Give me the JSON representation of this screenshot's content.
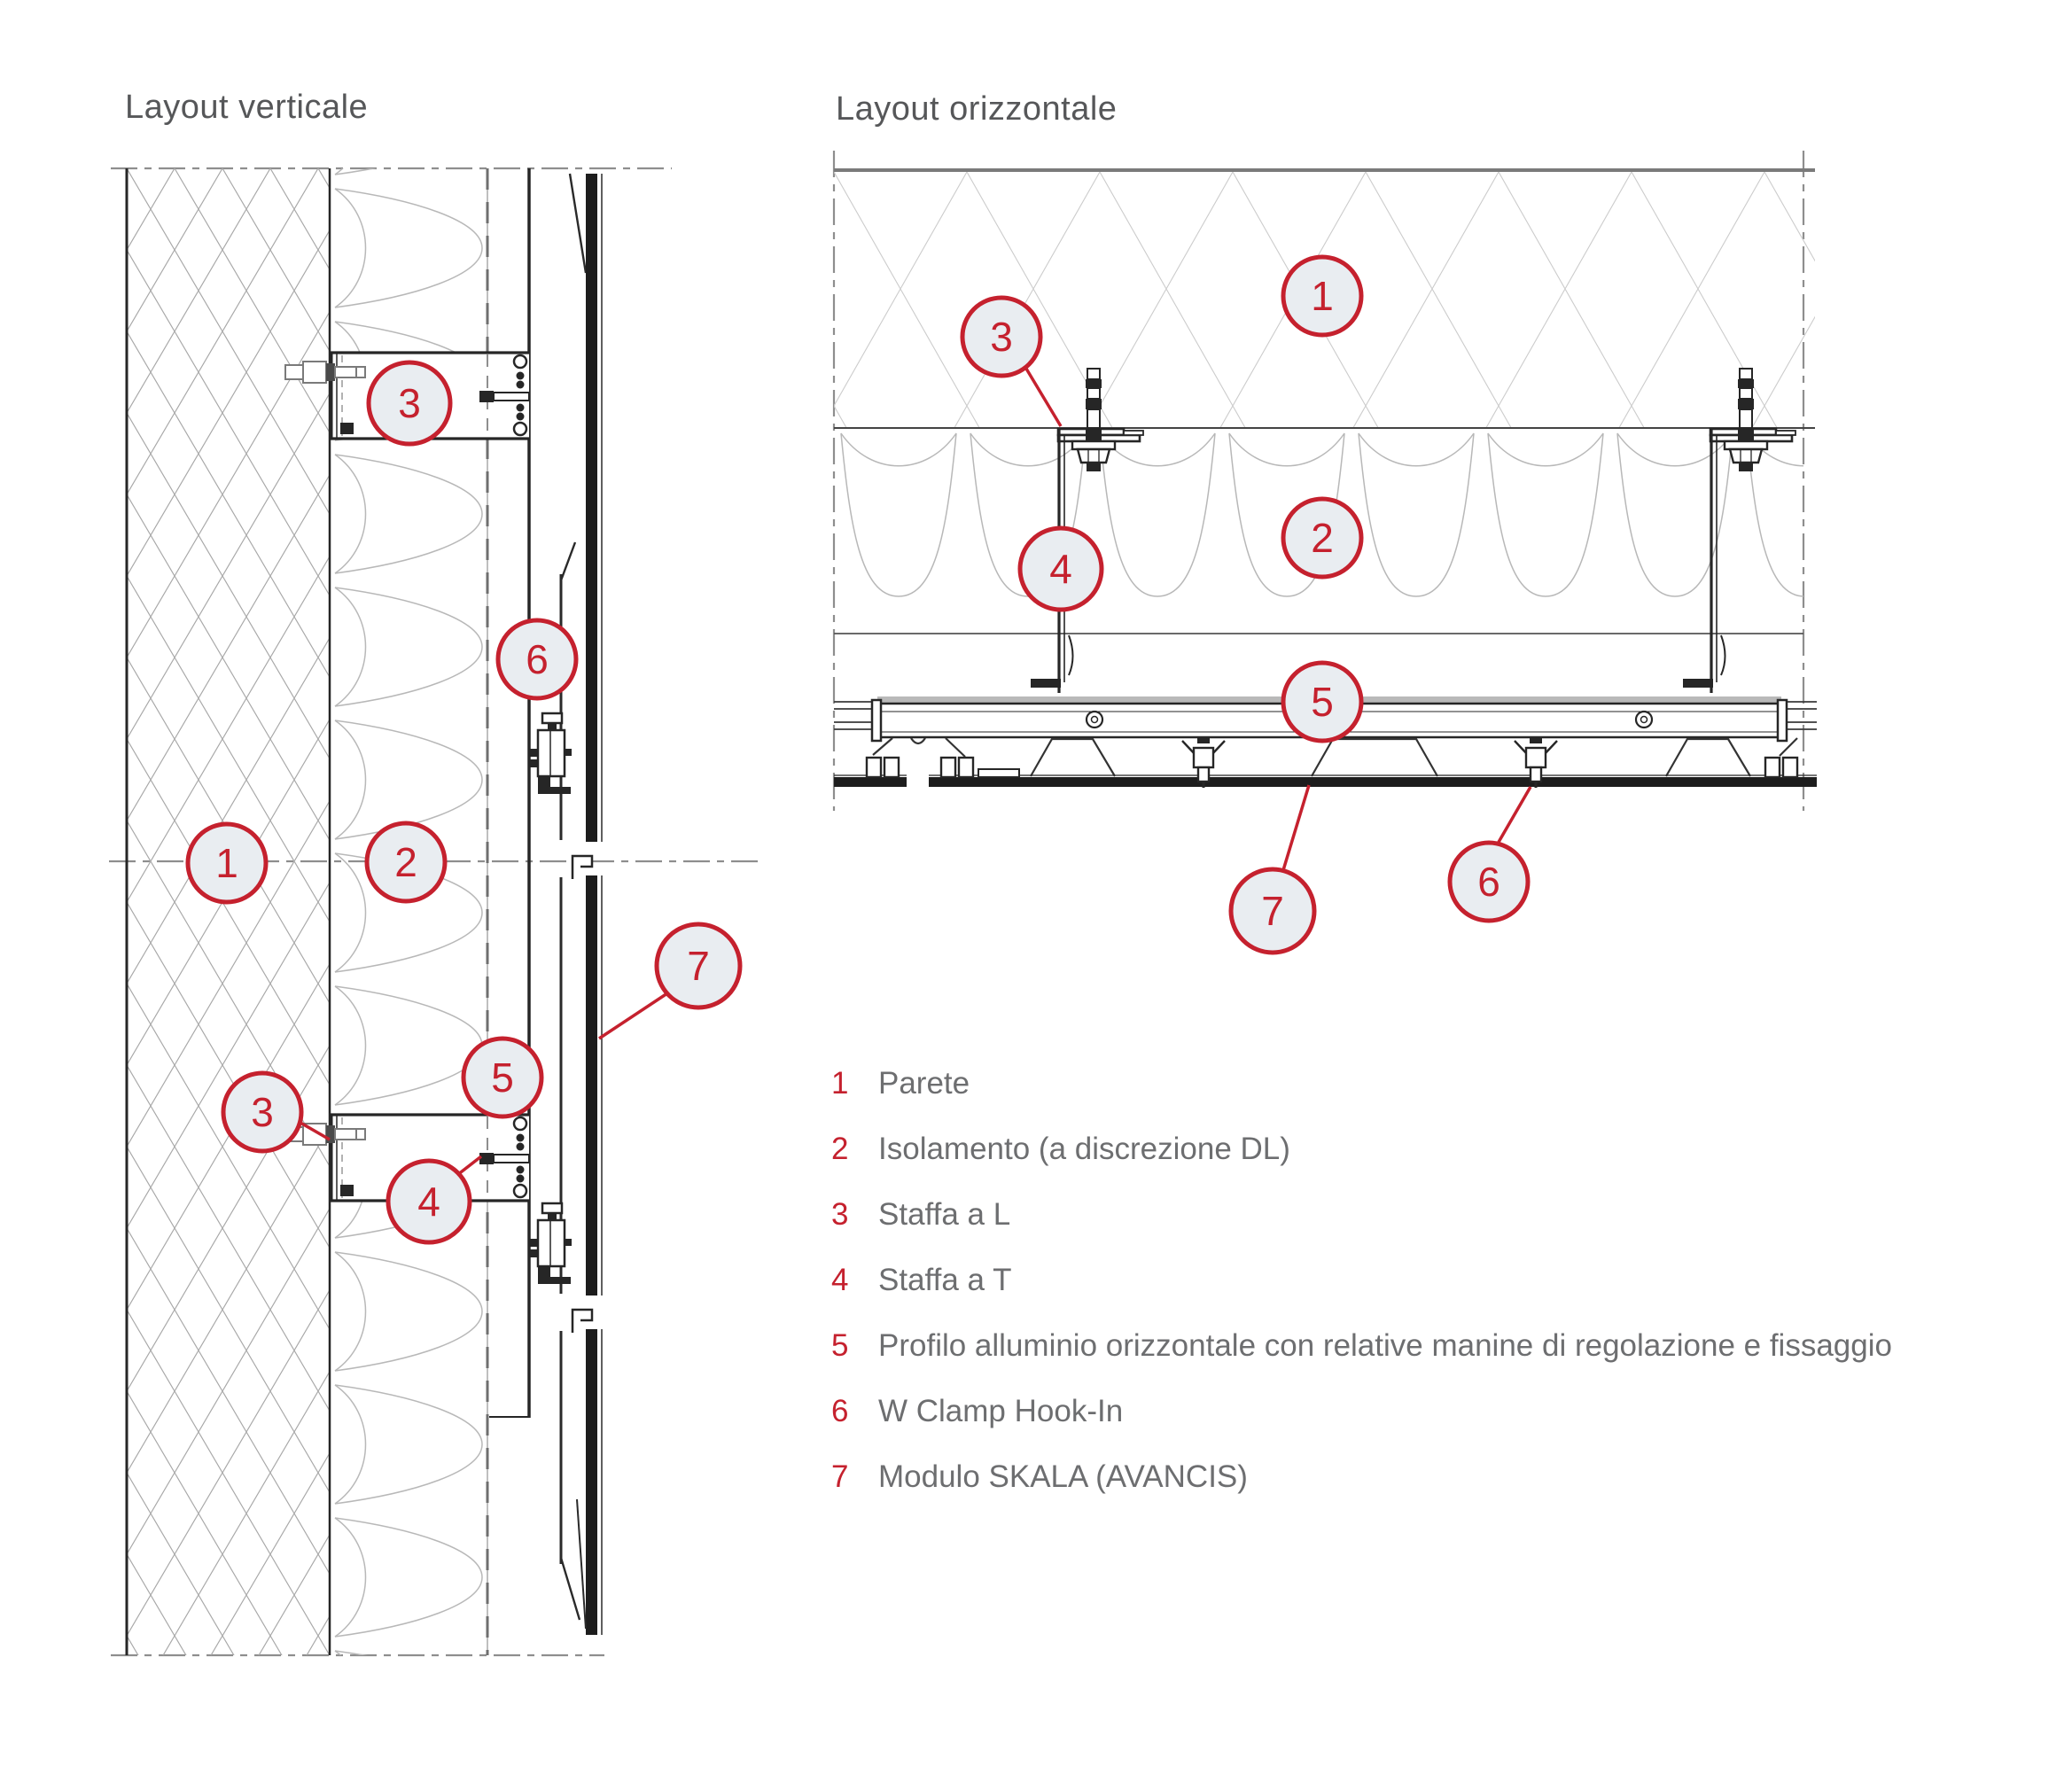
{
  "page": {
    "background": "#ffffff"
  },
  "colors": {
    "accent_red": "#c5212e",
    "callout_fill": "#e9edf1",
    "title_gray": "#565759",
    "legend_text_gray": "#6d6e70",
    "line_dark": "#262626",
    "hatch_gray": "#a8a8a8",
    "hatch_light_gray": "#cccccc",
    "insulation_gray": "#b8b8b8",
    "dashdot_gray": "#8e8e8e"
  },
  "diagrams": {
    "verticale": {
      "title": "Layout verticale",
      "callouts": [
        {
          "label": "3"
        },
        {
          "label": "6"
        },
        {
          "label": "1"
        },
        {
          "label": "2"
        },
        {
          "label": "7"
        },
        {
          "label": "5"
        },
        {
          "label": "3"
        },
        {
          "label": "4"
        }
      ]
    },
    "orizzontale": {
      "title": "Layout orizzontale",
      "callouts": [
        {
          "label": "1"
        },
        {
          "label": "3"
        },
        {
          "label": "2"
        },
        {
          "label": "4"
        },
        {
          "label": "5"
        },
        {
          "label": "6"
        },
        {
          "label": "7"
        }
      ]
    }
  },
  "legend": {
    "items": [
      {
        "number": "1",
        "label": "Parete"
      },
      {
        "number": "2",
        "label": "Isolamento (a discrezione DL)"
      },
      {
        "number": "3",
        "label": "Staffa a L"
      },
      {
        "number": "4",
        "label": "Staffa a T"
      },
      {
        "number": "5",
        "label": "Profilo alluminio orizzontale con relative manine di regolazione e fissaggio"
      },
      {
        "number": "6",
        "label": "W Clamp Hook-In"
      },
      {
        "number": "7",
        "label": "Modulo SKALA (AVANCIS)"
      }
    ]
  }
}
